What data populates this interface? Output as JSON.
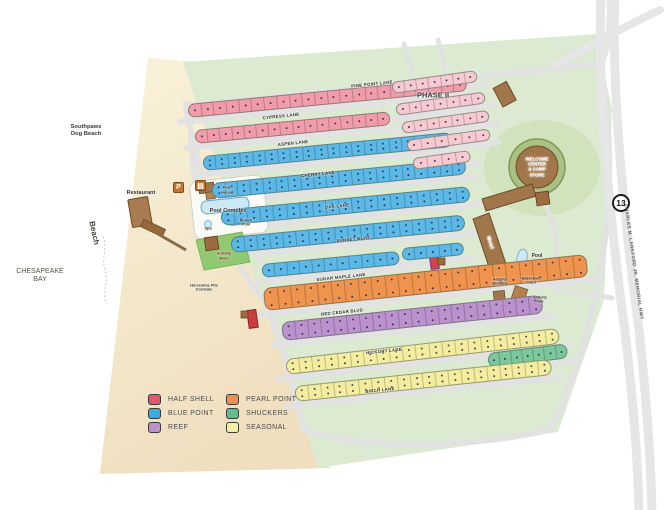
{
  "legend": {
    "items": [
      {
        "id": "half-shell",
        "label": "HALF SHELL",
        "color": "#e4566e"
      },
      {
        "id": "blue-point",
        "label": "BLUE POINT",
        "color": "#3aabdf"
      },
      {
        "id": "reef",
        "label": "REEF",
        "color": "#b792cc"
      },
      {
        "id": "pearl-point",
        "label": "PEARL POINT",
        "color": "#ef8f4e"
      },
      {
        "id": "shuckers",
        "label": "SHUCKERS",
        "color": "#5fbe8d"
      },
      {
        "id": "seasonal",
        "label": "SEASONAL",
        "color": "#f6f0a0"
      }
    ]
  },
  "map": {
    "route_shield": "13",
    "highway_label": "CHARLES M. LANKFORD JR. MEMORIAL HWY",
    "site_colors": {
      "half-shell": "#f19cab",
      "blue-point": "#5cb8e6",
      "reef": "#bb92ce",
      "pearl-point": "#ef944f",
      "shuckers": "#7cc79b",
      "seasonal": "#f4eda0",
      "phase2": "#f7c9d3"
    },
    "lanes": [
      {
        "t": "PINE POINT LANE",
        "x": 372,
        "y": 84,
        "r": -5.5
      },
      {
        "t": "CYPRESS LANE",
        "x": 281,
        "y": 116,
        "r": -6
      },
      {
        "t": "ASPEN LANE",
        "x": 293,
        "y": 143,
        "r": -6
      },
      {
        "t": "CHERRY LANE",
        "x": 318,
        "y": 174,
        "r": -6
      },
      {
        "t": "OAK LANE",
        "x": 337,
        "y": 206,
        "r": -6
      },
      {
        "t": "SUNSET BLVD",
        "x": 353,
        "y": 239,
        "r": -6
      },
      {
        "t": "SUGAR MAPLE LANE",
        "x": 341,
        "y": 277,
        "r": -6.5
      },
      {
        "t": "RED CEDAR BLVD",
        "x": 342,
        "y": 312,
        "r": -6.5
      },
      {
        "t": "HICKORY LANE",
        "x": 384,
        "y": 351,
        "r": -7
      },
      {
        "t": "BIRCH LANE",
        "x": 380,
        "y": 390,
        "r": -7
      }
    ],
    "rows": [
      {
        "c": "half-shell",
        "x": 188,
        "y": 104,
        "len": 280,
        "th": 14,
        "ang": -5.5,
        "cells": 22
      },
      {
        "c": "half-shell",
        "x": 195,
        "y": 130,
        "len": 196,
        "th": 14,
        "ang": -5.5,
        "cells": 16
      },
      {
        "c": "blue-point",
        "x": 203,
        "y": 156,
        "len": 250,
        "th": 15,
        "ang": -5.5,
        "cells": 20,
        "dbl": true
      },
      {
        "c": "blue-point",
        "x": 212,
        "y": 183,
        "len": 255,
        "th": 16,
        "ang": -5.5,
        "cells": 20,
        "dbl": true
      },
      {
        "c": "blue-point",
        "x": 221,
        "y": 210,
        "len": 250,
        "th": 16,
        "ang": -5.5,
        "cells": 19,
        "dbl": true
      },
      {
        "c": "blue-point",
        "x": 231,
        "y": 237,
        "len": 235,
        "th": 16,
        "ang": -5.5,
        "cells": 18,
        "dbl": true
      },
      {
        "c": "blue-point",
        "x": 262,
        "y": 264,
        "len": 138,
        "th": 14,
        "ang": -5.5,
        "cells": 11
      },
      {
        "c": "blue-point",
        "x": 402,
        "y": 248,
        "len": 62,
        "th": 13,
        "ang": -5.5,
        "cells": 5
      },
      {
        "c": "pearl-point",
        "x": 264,
        "y": 288,
        "len": 325,
        "th": 23,
        "ang": -6,
        "cells": 24,
        "dbl": true
      },
      {
        "c": "reef",
        "x": 282,
        "y": 322,
        "len": 262,
        "th": 19,
        "ang": -6,
        "cells": 20,
        "dbl": true
      },
      {
        "c": "shuckers",
        "x": 488,
        "y": 353,
        "len": 80,
        "th": 15,
        "ang": -7,
        "cells": 7
      },
      {
        "c": "seasonal",
        "x": 286,
        "y": 359,
        "len": 275,
        "th": 16,
        "ang": -6.5,
        "cells": 21,
        "dbl": true
      },
      {
        "c": "seasonal",
        "x": 295,
        "y": 386,
        "len": 258,
        "th": 16,
        "ang": -6,
        "cells": 20,
        "dbl": true
      },
      {
        "c": "phase2",
        "x": 392,
        "y": 82,
        "len": 86,
        "th": 12,
        "ang": -8,
        "cells": 7
      },
      {
        "c": "phase2",
        "x": 396,
        "y": 104,
        "len": 90,
        "th": 12,
        "ang": -8,
        "cells": 7
      },
      {
        "c": "phase2",
        "x": 402,
        "y": 122,
        "len": 88,
        "th": 12,
        "ang": -8,
        "cells": 7
      },
      {
        "c": "phase2",
        "x": 407,
        "y": 140,
        "len": 84,
        "th": 12,
        "ang": -8,
        "cells": 6
      },
      {
        "c": "phase2",
        "x": 413,
        "y": 158,
        "len": 58,
        "th": 12,
        "ang": -8,
        "cells": 4
      }
    ],
    "labels": [
      {
        "id": "chesapeake-bay",
        "t": "CHESAPEAKE\nBAY",
        "x": 40,
        "y": 276,
        "fs": 7,
        "c": "#55554a",
        "w": "400"
      },
      {
        "id": "beach",
        "t": "Beach",
        "x": 94,
        "y": 233,
        "fs": 8,
        "rot": 78,
        "c": "#44443a"
      },
      {
        "id": "dog-beach",
        "t": "Southpaws\nDog Beach",
        "x": 86,
        "y": 131,
        "fs": 5.8,
        "c": "#3b3b33"
      },
      {
        "id": "restaurant",
        "t": "Restaurant",
        "x": 141,
        "y": 193,
        "fs": 5.5
      },
      {
        "id": "pool-complex",
        "t": "Pool Complex",
        "x": 228,
        "y": 211,
        "fs": 5.5
      },
      {
        "id": "pool-house",
        "t": "Pool\nHouse",
        "x": 227,
        "y": 190,
        "fs": 4
      },
      {
        "id": "splash-pool",
        "t": "Splash\nPool",
        "x": 246,
        "y": 223,
        "fs": 3.8
      },
      {
        "id": "spa",
        "t": "Spa",
        "x": 208,
        "y": 229,
        "fs": 4
      },
      {
        "id": "activity-barn",
        "t": "Activity\nBarn",
        "x": 224,
        "y": 256,
        "fs": 4,
        "c": "#7c2a1a"
      },
      {
        "id": "horseshoe-pits",
        "t": "Horseshoe Pits\nCornhole",
        "x": 204,
        "y": 288,
        "fs": 3.8
      },
      {
        "id": "phase-2",
        "t": "PHASE II",
        "x": 433,
        "y": 96,
        "fs": 7.5,
        "c": "#3a3a3a"
      },
      {
        "id": "welcome-center",
        "t": "WELCOME\nCENTER\n& CAMP\nSTORE",
        "x": 537,
        "y": 167,
        "fs": 4.4,
        "c": "#ffffff"
      },
      {
        "id": "motel",
        "t": "Motel",
        "x": 489,
        "y": 243,
        "fs": 5,
        "rot": 72,
        "c": "#ffffff"
      },
      {
        "id": "pool-east",
        "t": "Pool",
        "x": 537,
        "y": 257,
        "fs": 5
      },
      {
        "id": "activity-building",
        "t": "Activity\nBuilding",
        "x": 500,
        "y": 282,
        "fs": 3.8
      },
      {
        "id": "basketball-court",
        "t": "Basketball\nCourt",
        "x": 531,
        "y": 281,
        "fs": 3.8
      },
      {
        "id": "activity-pad",
        "t": "Activity\nPad",
        "x": 540,
        "y": 300,
        "fs": 3.8
      }
    ],
    "icons": [
      {
        "id": "parking-icon",
        "glyph": "P",
        "x": 173,
        "y": 182,
        "bg": "#c4762c"
      },
      {
        "id": "restroom-icon",
        "glyph": "▤",
        "x": 195,
        "y": 180,
        "bg": "#c4762c"
      }
    ]
  }
}
